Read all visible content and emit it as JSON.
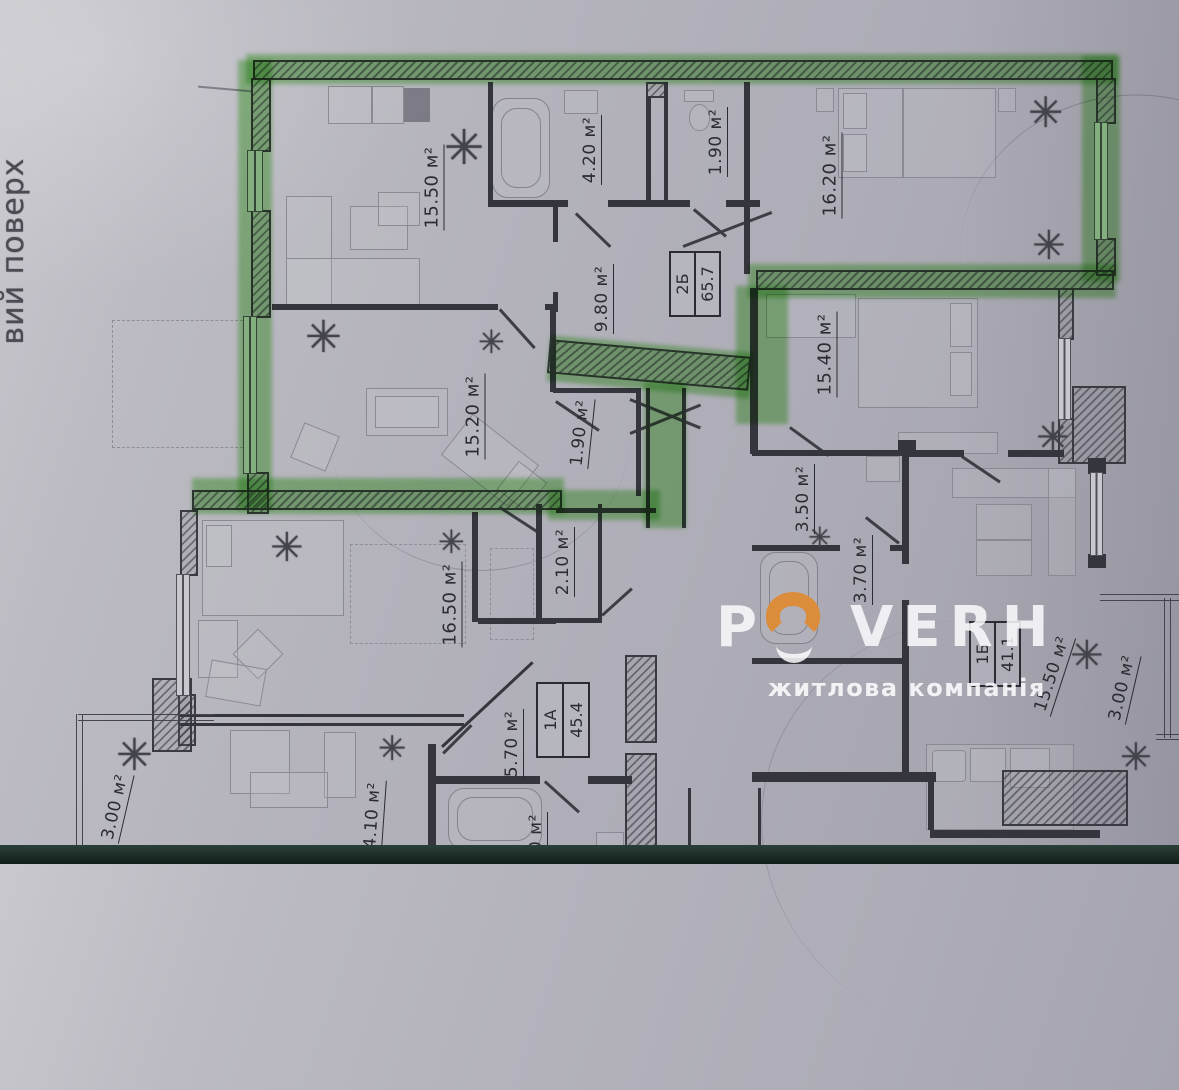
{
  "photo": {
    "side_caption": "вий поверх"
  },
  "icons": {
    "plant": "✳"
  },
  "watermark": {
    "letter_p": "P",
    "letters_rest": "VERH",
    "tagline": "житлова компанія",
    "orange": "#db8d3c"
  },
  "apartment_tags": [
    {
      "unit": "2Б",
      "area": "65.7"
    },
    {
      "unit": "1А",
      "area": "45.4"
    },
    {
      "unit": "1Б",
      "area": "41.1"
    }
  ],
  "room_labels": [
    {
      "text": "15.50 м²"
    },
    {
      "text": "4.20 м²"
    },
    {
      "text": "1.90 м²"
    },
    {
      "text": "16.20 м²"
    },
    {
      "text": "9.80 м²"
    },
    {
      "text": "15.20 м²"
    },
    {
      "text": "1.90 м²"
    },
    {
      "text": "15.40 м²"
    },
    {
      "text": "3.50 м²"
    },
    {
      "text": "3.70 м²"
    },
    {
      "text": "2.10 м²"
    },
    {
      "text": "16.50 м²"
    },
    {
      "text": "5.70 м²"
    },
    {
      "text": "15.50 м²"
    },
    {
      "text": "3.00 м²"
    },
    {
      "text": "3.00 м²"
    },
    {
      "text": "14.10 м²"
    },
    {
      "text": "0 м²"
    }
  ],
  "colors": {
    "highlight_green": "#58c23f",
    "paper": "#b4b3bc",
    "ink": "#2b2b33",
    "photo_edge": "#16241f",
    "brand_orange": "#db8d3c"
  }
}
